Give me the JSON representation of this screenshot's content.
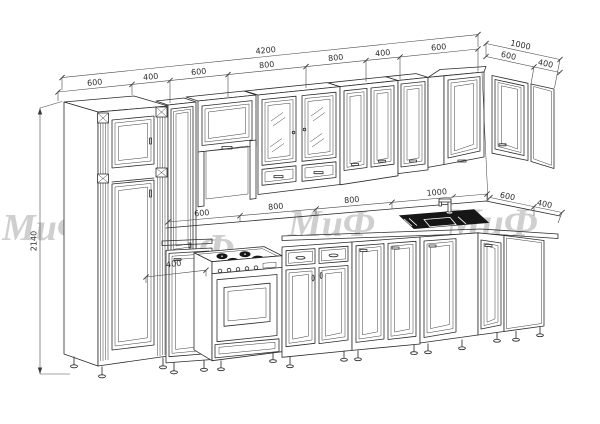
{
  "drawing_type": "kitchen-set perspective line drawing",
  "watermark": {
    "text": "МиФ",
    "color": "#cfcfcf"
  },
  "dimensions": {
    "overall_top": "4200",
    "overall_right": "1000",
    "height_left": "2140",
    "upper_chain": [
      "600",
      "400",
      "600",
      "800",
      "800",
      "400",
      "600"
    ],
    "upper_right_chain": [
      "600",
      "400"
    ],
    "counter_chain": [
      "600",
      "800",
      "800",
      "1000"
    ],
    "counter_right_chain": [
      "600",
      "400"
    ],
    "base_small": "400"
  }
}
